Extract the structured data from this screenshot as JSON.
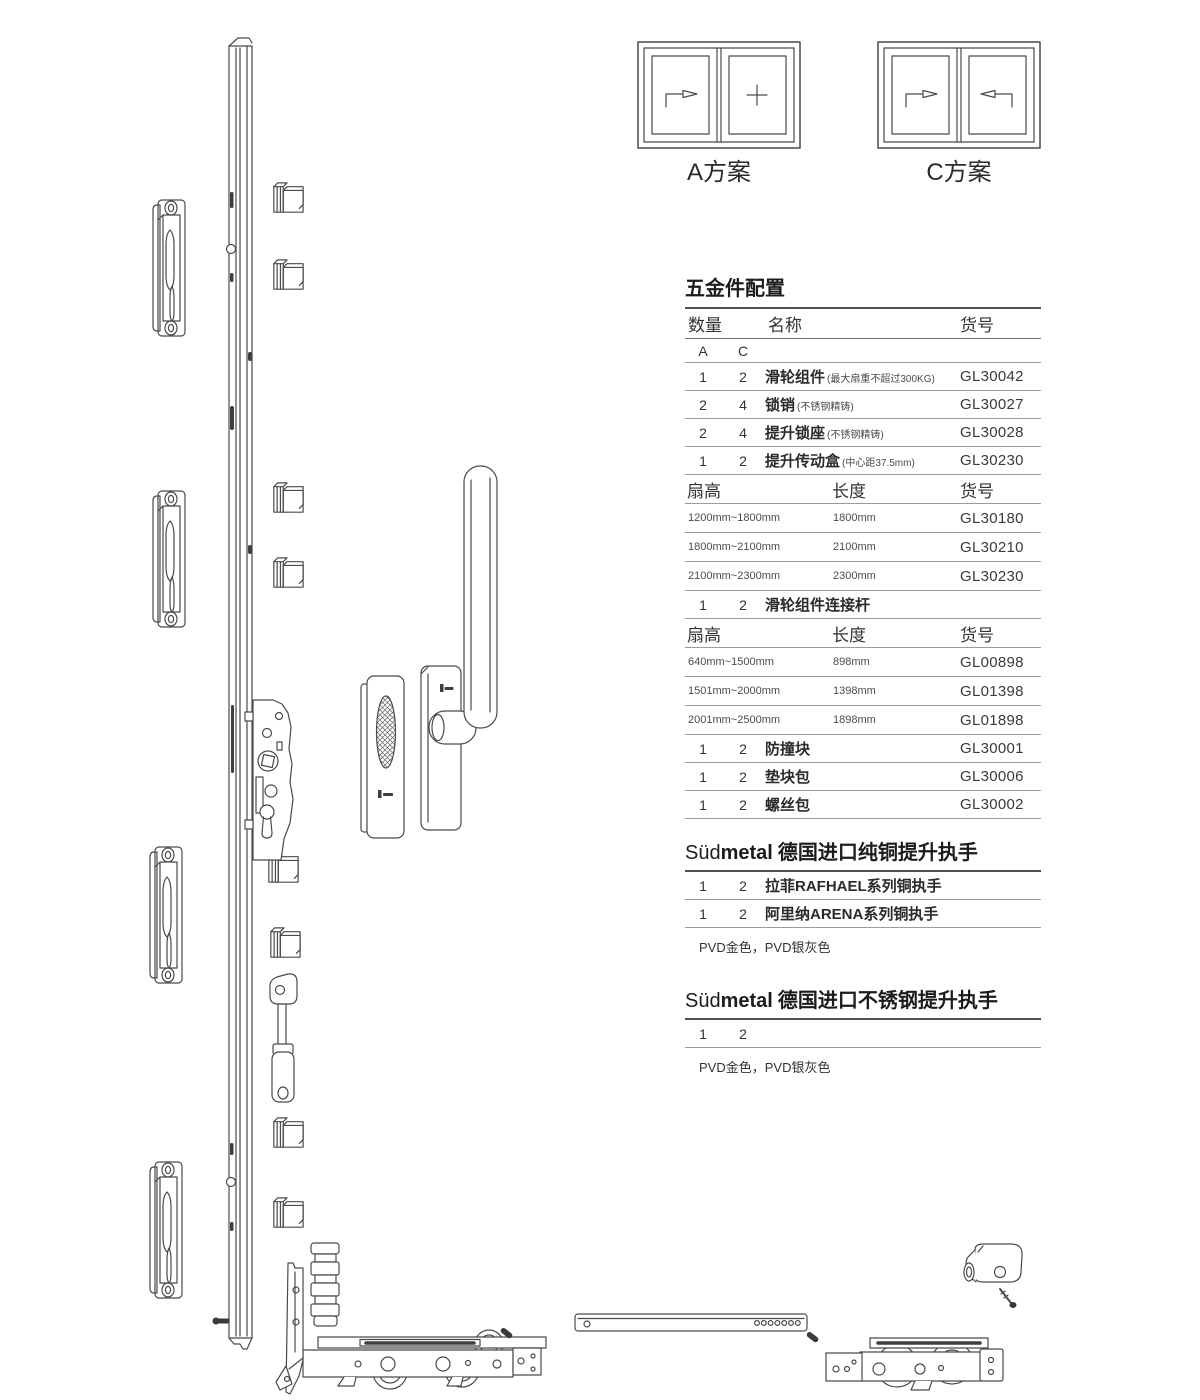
{
  "schemes": {
    "a_label": "A方案",
    "c_label": "C方案"
  },
  "hardware": {
    "title": "五金件配置",
    "columns": {
      "qty": "数量",
      "name": "名称",
      "code": "货号"
    },
    "sub": {
      "a": "A",
      "c": "C"
    },
    "parts1": [
      {
        "a": "1",
        "c": "2",
        "name": "滑轮组件",
        "note": "(最大扇重不超过300KG)",
        "code": "GL30042"
      },
      {
        "a": "2",
        "c": "4",
        "name": "锁销",
        "note": "(不锈钢精铸)",
        "code": "GL30027"
      },
      {
        "a": "2",
        "c": "4",
        "name": "提升锁座",
        "note": "(不锈钢精铸)",
        "code": "GL30028"
      },
      {
        "a": "1",
        "c": "2",
        "name": "提升传动盒",
        "note": "(中心距37.5mm)",
        "code": "GL30230"
      }
    ],
    "size_header": {
      "fan": "扇高",
      "len": "长度",
      "code": "货号"
    },
    "sizes1": [
      {
        "range": "1200mm~1800mm",
        "length": "1800mm",
        "code": "GL30180"
      },
      {
        "range": "1800mm~2100mm",
        "length": "2100mm",
        "code": "GL30210"
      },
      {
        "range": "2100mm~2300mm",
        "length": "2300mm",
        "code": "GL30230"
      }
    ],
    "connector_row": {
      "a": "1",
      "c": "2",
      "name": "滑轮组件连接杆"
    },
    "sizes2": [
      {
        "range": "640mm~1500mm",
        "length": "898mm",
        "code": "GL00898"
      },
      {
        "range": "1501mm~2000mm",
        "length": "1398mm",
        "code": "GL01398"
      },
      {
        "range": "2001mm~2500mm",
        "length": "1898mm",
        "code": "GL01898"
      }
    ],
    "parts2": [
      {
        "a": "1",
        "c": "2",
        "name": "防撞块",
        "code": "GL30001"
      },
      {
        "a": "1",
        "c": "2",
        "name": "垫块包",
        "code": "GL30006"
      },
      {
        "a": "1",
        "c": "2",
        "name": "螺丝包",
        "code": "GL30002"
      }
    ]
  },
  "brass": {
    "brand_sud": "Süd",
    "brand_metal": "metal",
    "title": "德国进口纯铜提升执手",
    "rows": [
      {
        "a": "1",
        "c": "2",
        "name": "拉菲RAFHAEL系列铜执手"
      },
      {
        "a": "1",
        "c": "2",
        "name": "阿里纳ARENA系列铜执手"
      }
    ],
    "note": "PVD金色，PVD银灰色"
  },
  "steel": {
    "brand_sud": "Süd",
    "brand_metal": "metal",
    "title": "德国进口不锈钢提升执手",
    "rows": [
      {
        "a": "1",
        "c": "2"
      }
    ],
    "note": "PVD金色，PVD银灰色"
  }
}
